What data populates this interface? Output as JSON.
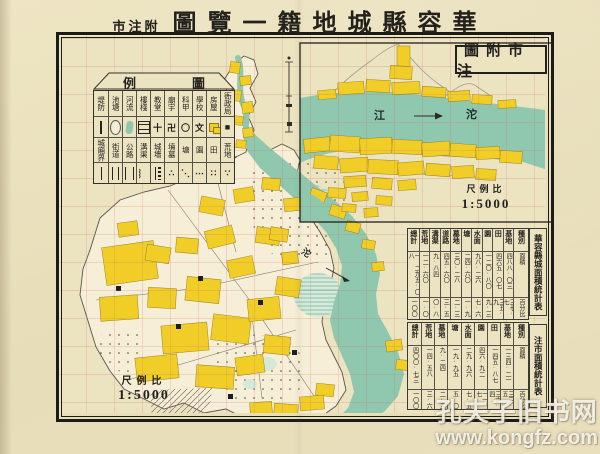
{
  "colors": {
    "paper": "#eae0bd",
    "building_yellow": "#f1cd28",
    "water_teal": "#8fc8ae",
    "grid_red": "#c4705c",
    "ink": "#23211c"
  },
  "title": {
    "annotation": "市注附",
    "main": "圖覽一籍地城縣容華"
  },
  "legend": {
    "header_left": "例",
    "header_right": "圖",
    "columns": [
      {
        "top": "堤防",
        "top_symbol": {
          "shape": "dike"
        },
        "bottom": "城廂界",
        "bottom_symbol": {
          "shape": "boundary"
        }
      },
      {
        "top": "池塘",
        "top_symbol": {
          "shape": "pond"
        },
        "bottom": "街道",
        "bottom_symbol": {
          "shape": "street"
        }
      },
      {
        "top": "河流",
        "top_symbol": {
          "shape": "river"
        },
        "bottom": "公路",
        "bottom_symbol": {
          "shape": "road"
        }
      },
      {
        "top": "樓棧",
        "top_symbol": {
          "shape": "building"
        },
        "bottom": "溝渠",
        "bottom_symbol": {
          "glyph": "︴"
        }
      },
      {
        "top": "教堂",
        "top_symbol": {
          "glyph": "十"
        },
        "bottom": "城墻",
        "bottom_symbol": {
          "shape": "wall"
        }
      },
      {
        "top": "廟宇",
        "top_symbol": {
          "glyph": "卍"
        },
        "bottom": "墳墓",
        "bottom_symbol": {
          "glyph": "∴"
        }
      },
      {
        "top": "科甲",
        "top_symbol": {
          "glyph": "〇"
        },
        "bottom": "塘",
        "bottom_symbol": {
          "glyph": "⋱"
        }
      },
      {
        "top": "學校",
        "top_symbol": {
          "glyph": "文"
        },
        "bottom": "園",
        "bottom_symbol": {
          "glyph": "⋯"
        }
      },
      {
        "top": "房屋",
        "top_symbol": {
          "shape": "houses"
        },
        "bottom": "田",
        "bottom_symbol": {
          "glyph": "∷"
        }
      },
      {
        "top": "衙政局",
        "top_symbol": {
          "glyph": "■"
        },
        "bottom": "荒地",
        "bottom_symbol": {
          "glyph": "∵"
        }
      }
    ]
  },
  "inset": {
    "title": "圖附市注",
    "river_label_left": "江",
    "river_label_right": "沱",
    "scale": {
      "label": "尺例比",
      "value": "1:5000"
    }
  },
  "main_map": {
    "river_label": "沱",
    "scale": {
      "label": "尺例比",
      "value": "1:5000"
    }
  },
  "tables": {
    "city": {
      "title": "華容縣城面積統計表",
      "headers": [
        "總計",
        "荒地",
        "溝渠",
        "道路",
        "墓地",
        "塘",
        "水面",
        "園",
        "田",
        "基地",
        "種別"
      ],
      "rows": [
        [
          "一、二九五·〇八",
          "一二·六〇",
          "九·八四",
          "四五·六〇",
          "三〇·二八",
          "二四·六〇",
          "九八·二六",
          "一二〇·八〇",
          "四六五·〇七",
          "四八八·〇三",
          "面積"
        ],
        [
          "一〇〇",
          "一·〇",
          "〇·八",
          "三·五",
          "二·三",
          "一·九",
          "七·六",
          "九·三",
          "三五·九",
          "三七·七",
          "百分比"
        ]
      ]
    },
    "town": {
      "title": "注市面積統計表",
      "headers": [
        "總計",
        "荒地",
        "墓地",
        "塘",
        "水面",
        "園",
        "田",
        "基地",
        "種別"
      ],
      "rows": [
        [
          "四〇〇·七三",
          "一四·五八",
          "九·二四",
          "一九·九五",
          "二九·九六",
          "四六·九二",
          "一四五·八七",
          "一三四·二一",
          "面積"
        ],
        [
          "一〇〇",
          "三·六",
          "二·三",
          "五·〇",
          "七·五",
          "一一·七",
          "三六·四",
          "三三·五",
          "百分比"
        ]
      ]
    }
  },
  "watermark": {
    "line1": "孔夫子旧书网",
    "line2": "www.kongfz.com"
  }
}
